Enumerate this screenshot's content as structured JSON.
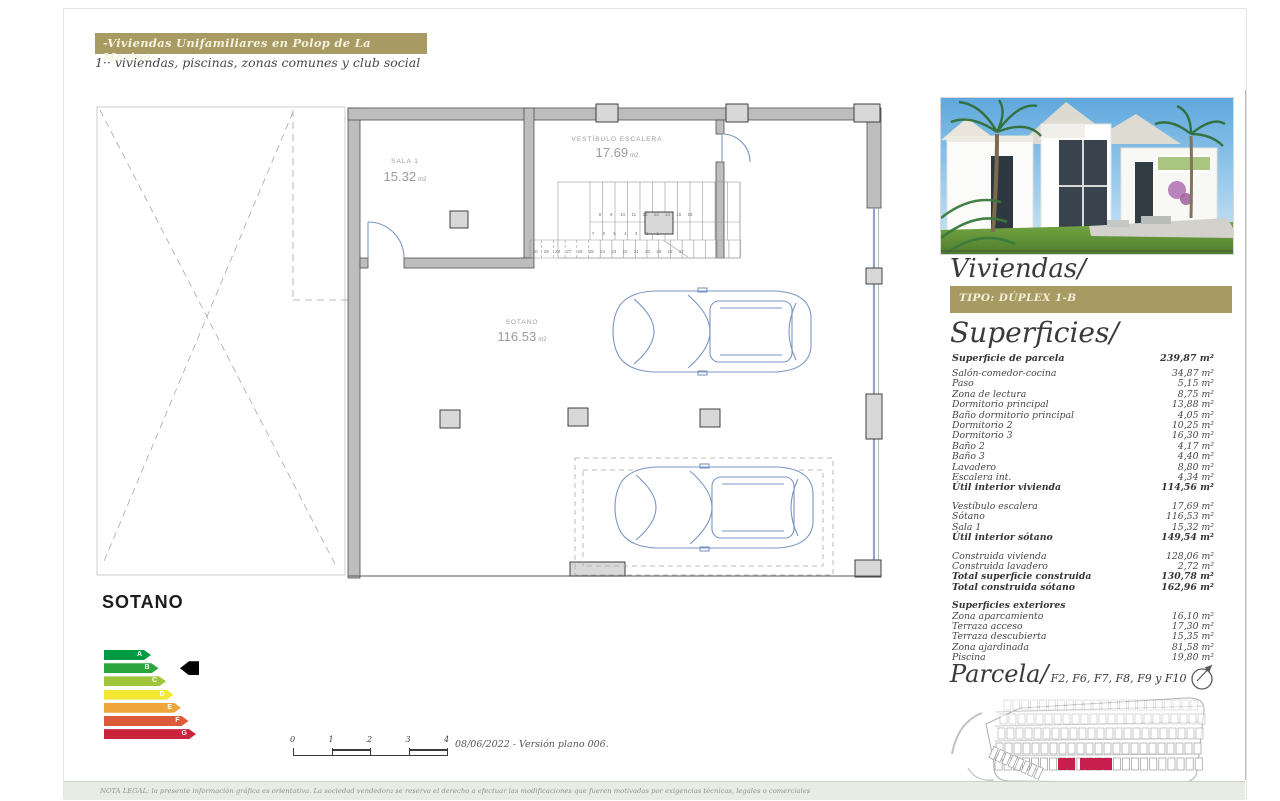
{
  "header": {
    "title": "-Viviendas Unifamiliares en Polop de La Marina-",
    "subtitle": "1·· viviendas, piscinas, zonas comunes y club social"
  },
  "plan": {
    "floor_title": "SOTANO",
    "rooms": [
      {
        "label": "SALA 1",
        "area": "15.32",
        "unit": "m2"
      },
      {
        "label": "VESTÍBULO ESCALERA",
        "area": "17.69",
        "unit": "m2"
      },
      {
        "label": "SOTANO",
        "area": "116.53",
        "unit": "m2"
      }
    ],
    "stairs": {
      "top_row": [
        "8",
        "9",
        "10",
        "11",
        "12",
        "13",
        "14",
        "15",
        "16"
      ],
      "mid_row": [
        "7",
        "6",
        "5",
        "4",
        "3",
        "2",
        "1"
      ],
      "bottom_row": [
        "30",
        "29",
        "28",
        "27",
        "26",
        "25",
        "24",
        "23",
        "22",
        "21",
        "20",
        "19",
        "18",
        "17"
      ]
    }
  },
  "energy": {
    "current": "B",
    "ratings": [
      {
        "label": "A",
        "color": "#009a44"
      },
      {
        "label": "B",
        "color": "#2ca63c"
      },
      {
        "label": "C",
        "color": "#9fc63b"
      },
      {
        "label": "D",
        "color": "#f2e831"
      },
      {
        "label": "E",
        "color": "#eda53c"
      },
      {
        "label": "F",
        "color": "#dc5b3a"
      },
      {
        "label": "G",
        "color": "#c9243b"
      }
    ]
  },
  "scalebar": {
    "ticks": [
      "0",
      "1",
      "2",
      "3",
      "4"
    ],
    "caption": "08/06/2022 - Versión plano 006."
  },
  "sidebar": {
    "title": "Viviendas/",
    "type_label": "TIPO: DÚPLEX 1-B",
    "surfaces_title": "Superficies/",
    "headline": {
      "label": "Superficie de parcela",
      "value": "239,87 m²"
    },
    "surfaces": {
      "groups": [
        {
          "rows": [
            {
              "label": "Salón-comedor-cocina",
              "value": "34,87 m²"
            },
            {
              "label": "Paso",
              "value": "5,15 m²"
            },
            {
              "label": "Zona de lectura",
              "value": "8,75 m²"
            },
            {
              "label": "Dormitorio principal",
              "value": "13,88 m²"
            },
            {
              "label": "Baño dormitorio principal",
              "value": "4,05 m²"
            },
            {
              "label": "Dormitorio 2",
              "value": "10,25 m²"
            },
            {
              "label": "Dormitorio 3",
              "value": "16,30 m²"
            },
            {
              "label": "Baño 2",
              "value": "4,17 m²"
            },
            {
              "label": "Baño 3",
              "value": "4,40 m²"
            },
            {
              "label": "Lavadero",
              "value": "8,80 m²"
            },
            {
              "label": "Escalera int.",
              "value": "4,34 m²"
            },
            {
              "label": "Útil interior vivienda",
              "value": "114,56 m²",
              "bold": true
            }
          ]
        },
        {
          "rows": [
            {
              "label": "Vestíbulo escalera",
              "value": "17,69 m²"
            },
            {
              "label": "Sótano",
              "value": "116,53 m²"
            },
            {
              "label": "Sala 1",
              "value": "15,32 m²"
            },
            {
              "label": "Útil interior sótano",
              "value": "149,54 m²",
              "bold": true
            }
          ]
        },
        {
          "rows": [
            {
              "label": "Construida vivienda",
              "value": "128,06 m²"
            },
            {
              "label": "Construida lavadero",
              "value": "2,72 m²"
            },
            {
              "label": "Total superficie construida",
              "value": "130,78 m²",
              "bold": true
            },
            {
              "label": "Total construida sótano",
              "value": "162,96 m²",
              "bold": true
            }
          ]
        },
        {
          "title": "Superficies exteriores",
          "rows": [
            {
              "label": "Zona aparcamiento",
              "value": "16,10 m²"
            },
            {
              "label": "Terraza acceso",
              "value": "17,30 m²"
            },
            {
              "label": "Terraza descubierta",
              "value": "15,35 m²"
            },
            {
              "label": "Zona ajardinada",
              "value": "81,58 m²"
            },
            {
              "label": "Piscina",
              "value": "19,80 m²"
            }
          ]
        }
      ]
    }
  },
  "parcela": {
    "title": "Parcela/",
    "plots": "F2, F6, F7, F8, F9 y F10"
  },
  "legal": {
    "note": "NOTA LEGAL: la presente información gráfica es orientativa. La sociedad vendedora se reserva el derecho a efectuar las modificaciones que fueren motivadas por exigencias técnicas, legales o comerciales"
  },
  "colors": {
    "gold": "#a79a63",
    "highlight": "#c81e4e",
    "plan_accent": "#7a96c4",
    "energy_cursor": "#000000"
  }
}
